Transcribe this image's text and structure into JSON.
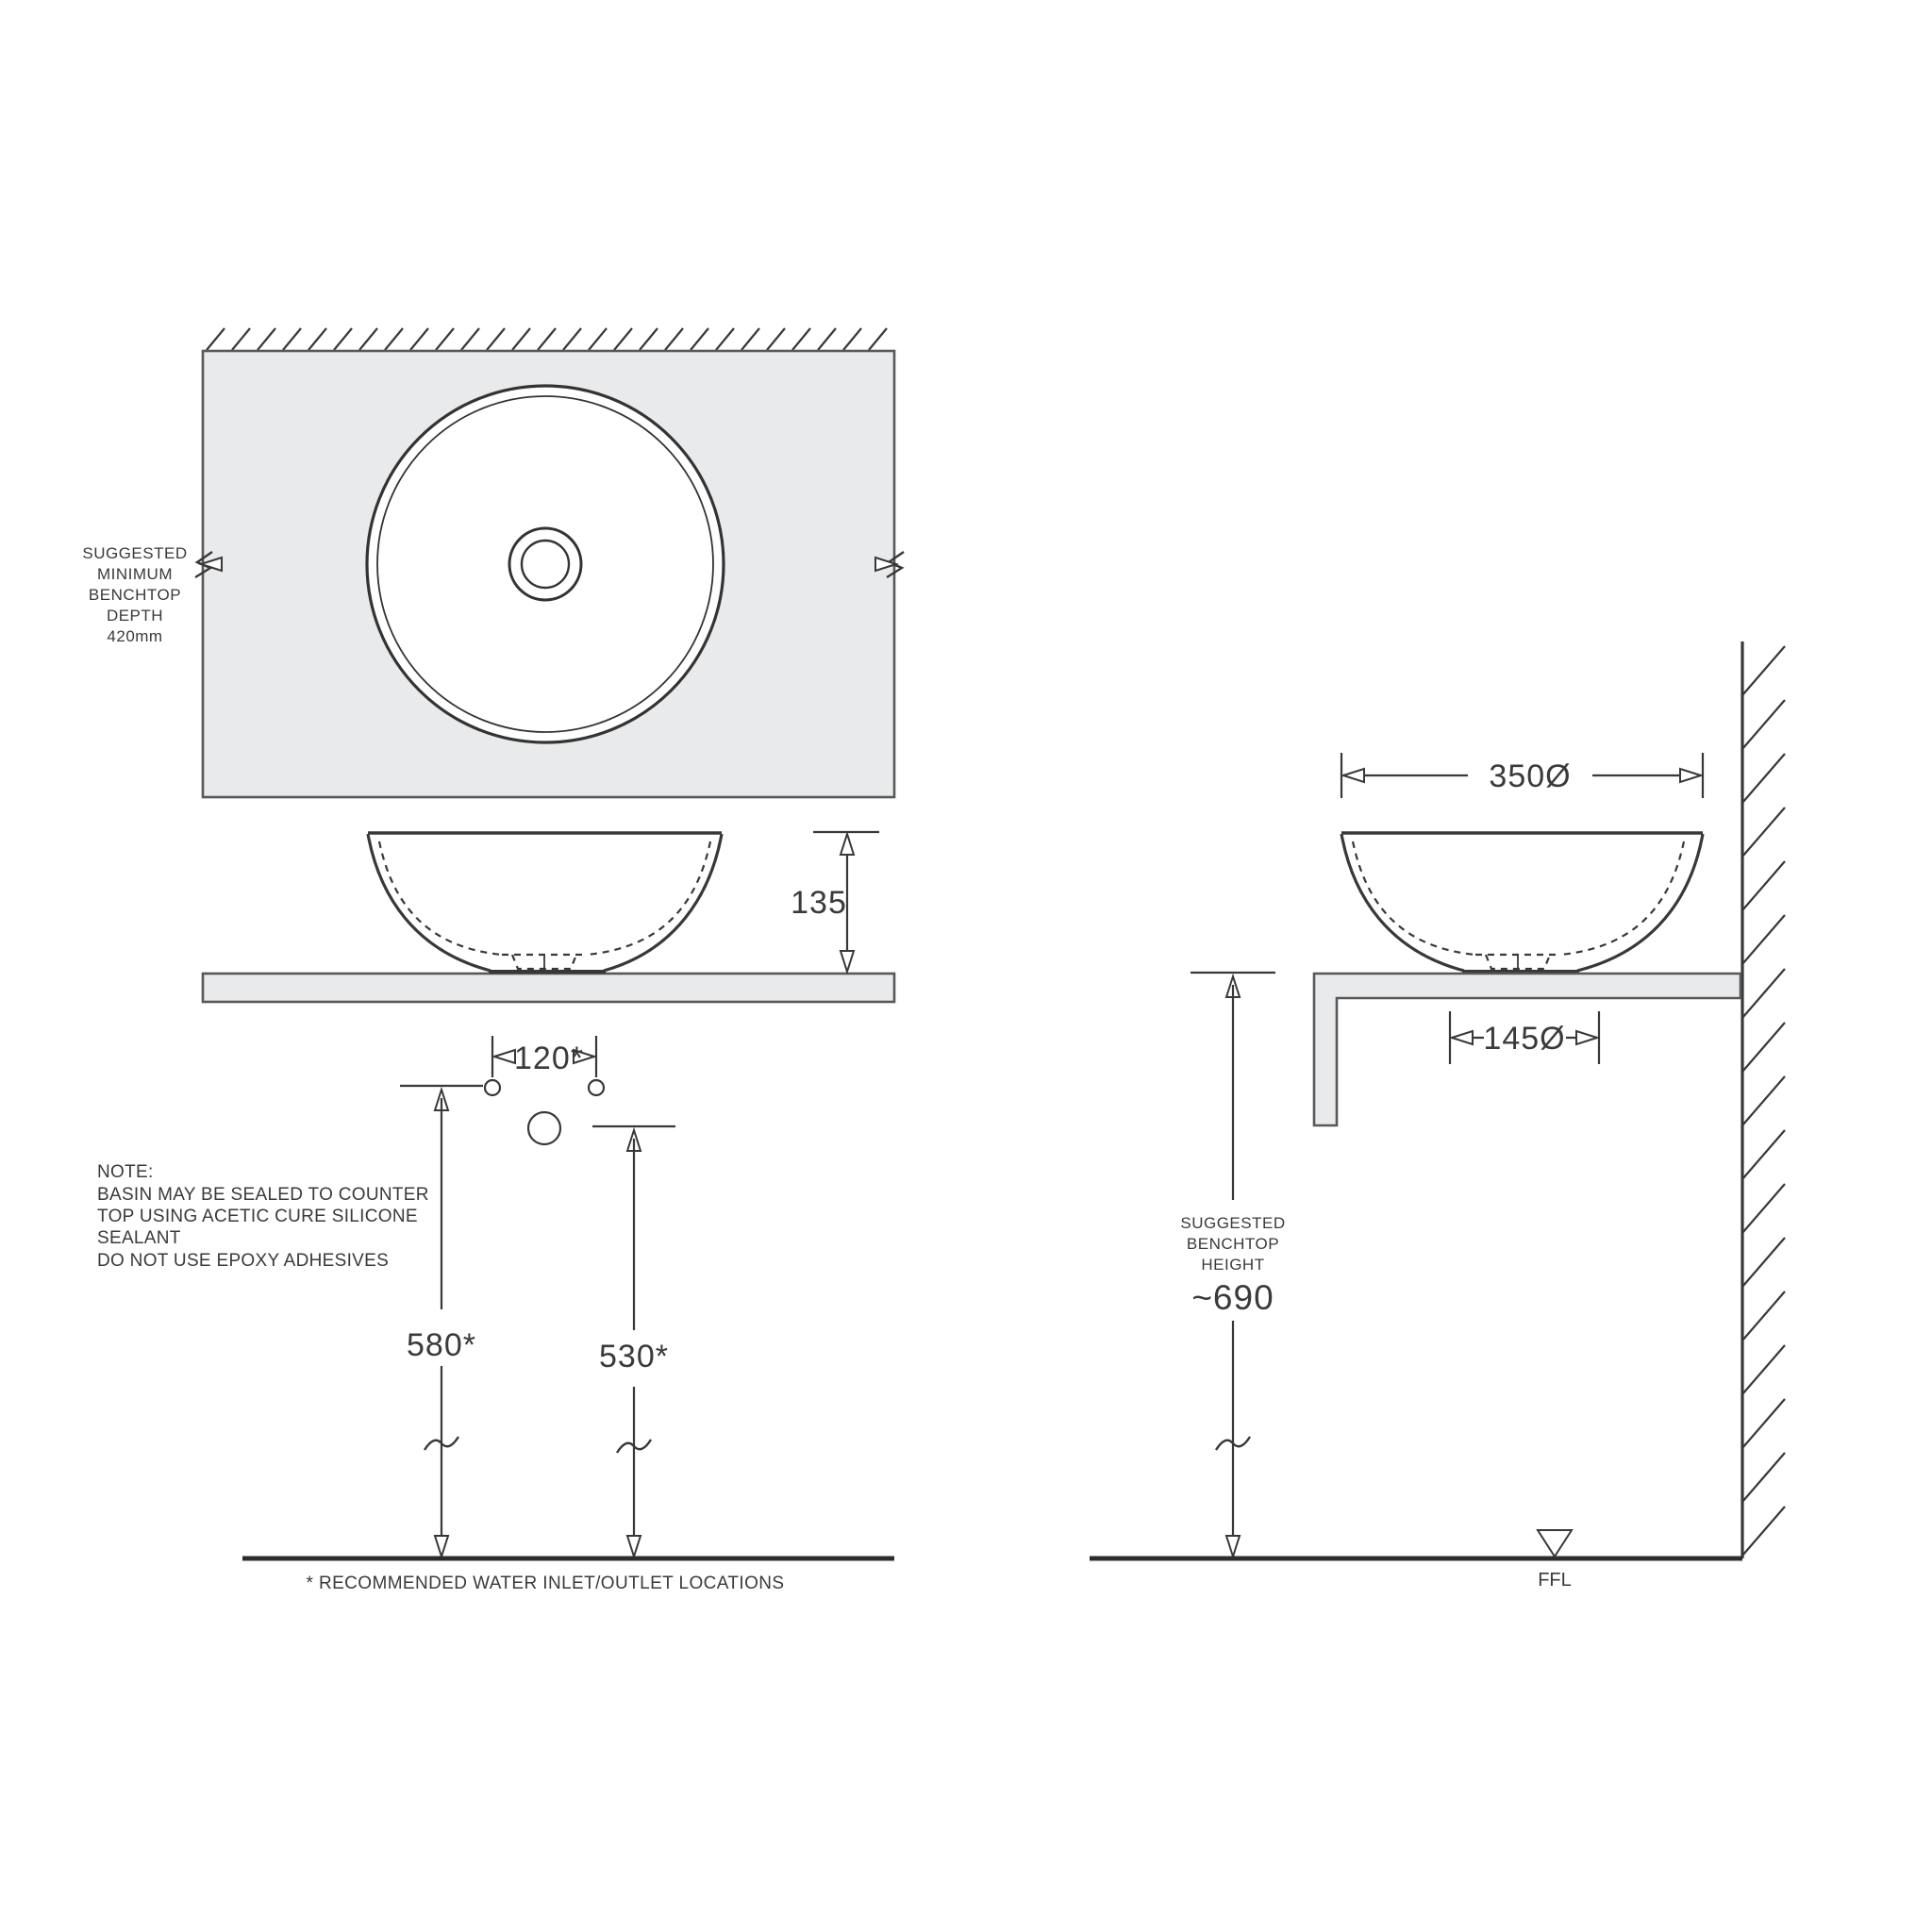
{
  "drawing": {
    "plan": {
      "depth_note_lines": [
        "SUGGESTED",
        "MINIMUM",
        "BENCHTOP",
        "DEPTH",
        "420mm"
      ]
    },
    "front": {
      "height_dim": "135"
    },
    "holes": {
      "spacing_dim": "120*",
      "inlet_height_dim": "580*",
      "outlet_height_dim": "530*"
    },
    "note_lines": [
      "NOTE:",
      "BASIN MAY BE SEALED TO COUNTER",
      "TOP USING ACETIC CURE SILICONE",
      "SEALANT",
      "DO NOT USE EPOXY ADHESIVES"
    ],
    "footnote": "* RECOMMENDED WATER INLET/OUTLET LOCATIONS",
    "side": {
      "rim_diameter_dim": "350Ø",
      "base_diameter_dim": "145Ø",
      "height_note_lines": [
        "SUGGESTED",
        "BENCHTOP",
        "HEIGHT"
      ],
      "height_value": "~690",
      "floor_label": "FFL"
    },
    "colors": {
      "line": "#3a3a3a",
      "surface_fill": "#e9eaeb",
      "background": "#ffffff"
    }
  }
}
